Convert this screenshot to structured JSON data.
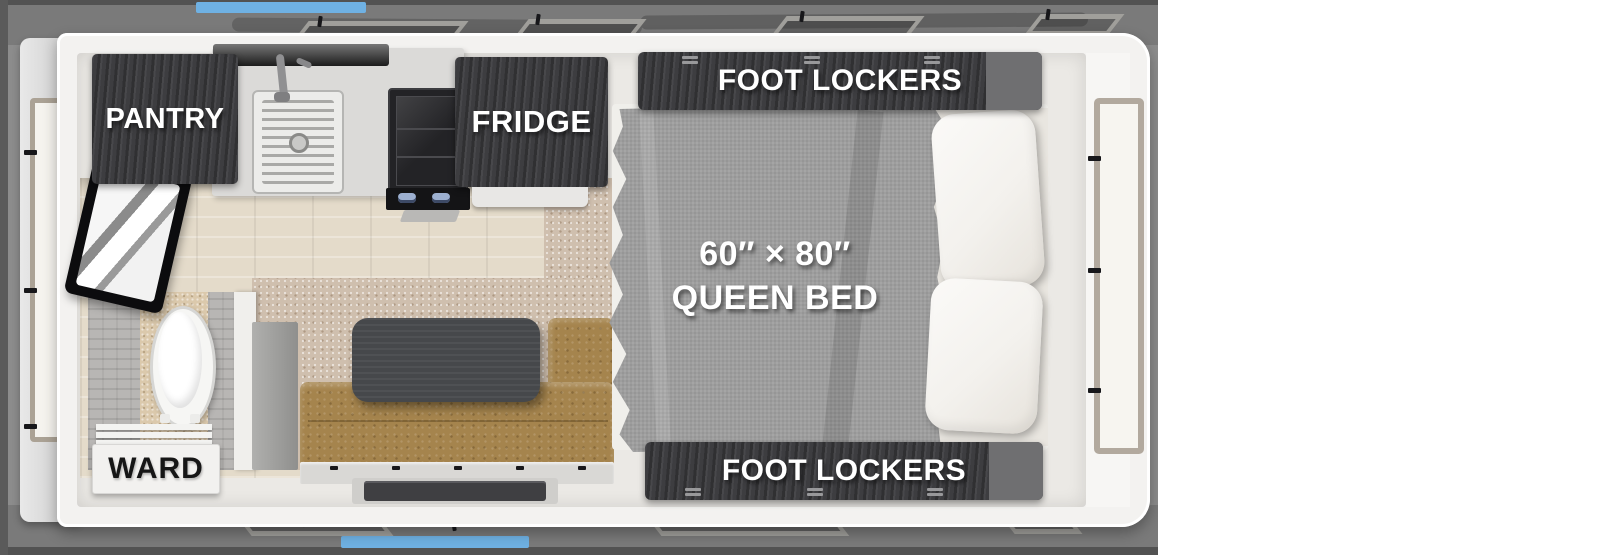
{
  "floorplan": {
    "labels": {
      "pantry": "PANTRY",
      "fridge": "FRIDGE",
      "foot_lockers_top": "FOOT LOCKERS",
      "foot_lockers_bottom": "FOOT LOCKERS",
      "ward": "WARD",
      "bed_size": "60″ × 80″",
      "bed_name": "QUEEN BED"
    },
    "colors": {
      "background_gray": "#8c8c8c",
      "band_gray": "#7a7a7a",
      "edge_gray": "#525252",
      "accent_blue": "#6fb1e3",
      "shell_white": "#f3f2f0",
      "interior_floor": "#ebe9e5",
      "cabinet_dark": "#3d3d40",
      "label_text": "#ffffff",
      "ward_text": "#161616",
      "bed_gray": "#9e9e9e",
      "pillow_white": "#f7f5f1",
      "bench_brown": "#a5844d",
      "table_dark": "#46484b",
      "carpet_tan": "#cfbfae",
      "wood_floor": "#e4dbca"
    }
  }
}
